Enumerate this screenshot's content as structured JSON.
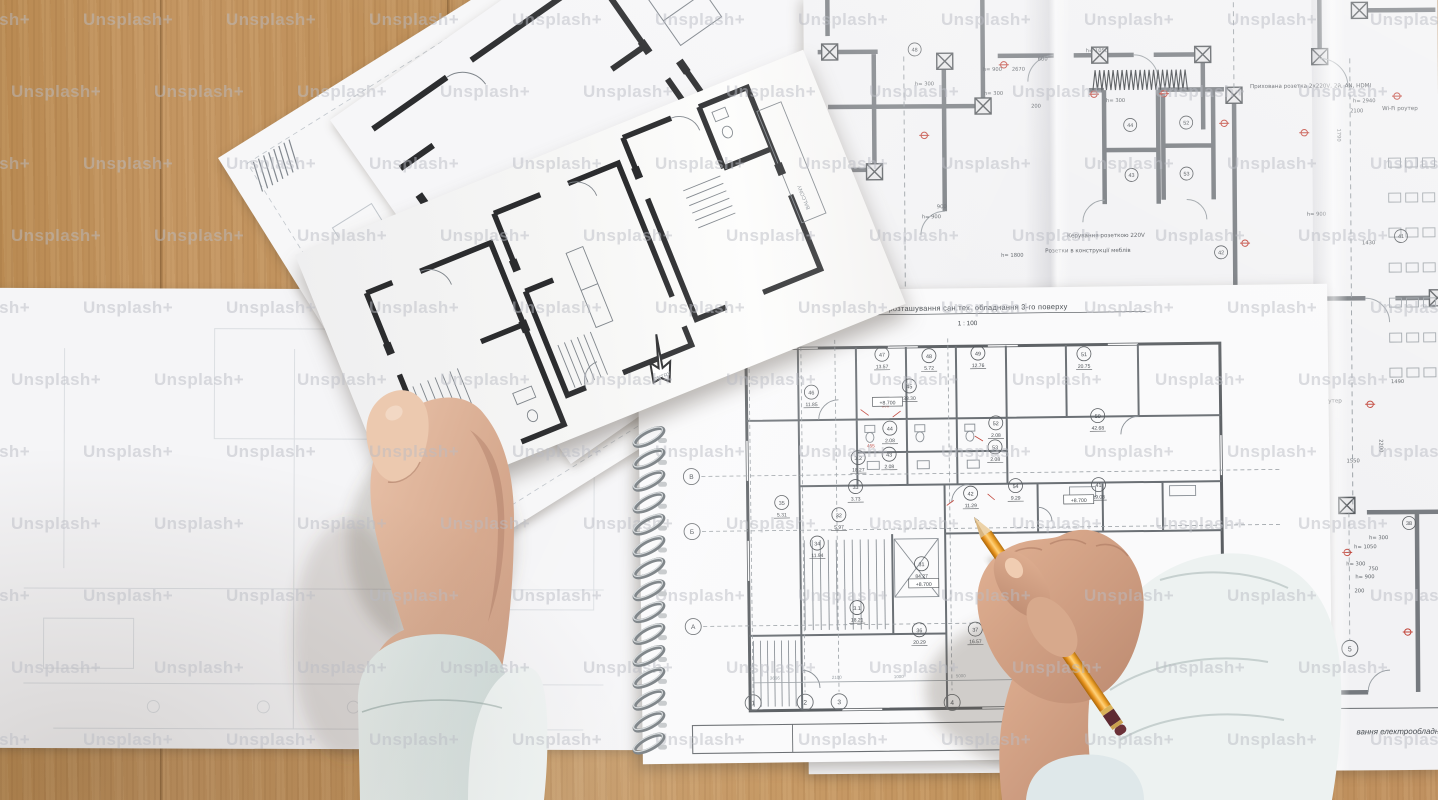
{
  "watermark": {
    "text": "Unsplash+"
  },
  "notebook": {
    "title": "План розташування сан.тех. обладнання 3-го поверху",
    "scale": "1 : 100",
    "page_number": "13",
    "titleblock_partial": "…поверху",
    "grid_rows": [
      "В",
      "Б",
      "А"
    ],
    "grid_cols": [
      "1",
      "2",
      "3",
      "4"
    ],
    "elevation_mark": "+8.700",
    "elevation_positions": [
      {
        "x": 249,
        "y": 114
      },
      {
        "x": 283,
        "y": 296
      },
      {
        "x": 439,
        "y": 214
      }
    ],
    "faint_dims": [
      "3666",
      "2100",
      "1000",
      "5000"
    ],
    "red_dims": [
      "500",
      "455"
    ],
    "rooms": [
      {
        "num": "46",
        "area": "11.85",
        "x": 173,
        "y": 107
      },
      {
        "num": "47",
        "area": "13.57",
        "x": 244,
        "y": 70
      },
      {
        "num": "48",
        "area": "5.72",
        "x": 291,
        "y": 72
      },
      {
        "num": "49",
        "area": "12.76",
        "x": 340,
        "y": 70
      },
      {
        "num": "51",
        "area": "20.75",
        "x": 446,
        "y": 72
      },
      {
        "num": "45",
        "area": "38.30",
        "x": 271,
        "y": 102
      },
      {
        "num": "44",
        "area": "2.08",
        "x": 251,
        "y": 144
      },
      {
        "num": "43",
        "area": "2.08",
        "x": 250,
        "y": 170
      },
      {
        "num": "52",
        "area": "2.08",
        "x": 357,
        "y": 140
      },
      {
        "num": "53",
        "area": "2.08",
        "x": 356,
        "y": 164
      },
      {
        "num": "50",
        "area": "42.68",
        "x": 459,
        "y": 134
      },
      {
        "num": "42",
        "area": "11.29",
        "x": 331,
        "y": 210
      },
      {
        "num": "54",
        "area": "9.29",
        "x": 376,
        "y": 203
      },
      {
        "num": "41",
        "area": "19.08",
        "x": 459,
        "y": 203
      },
      {
        "num": "3.2",
        "area": "18.27",
        "x": 219,
        "y": 173
      },
      {
        "num": "33",
        "area": "3.73",
        "x": 216,
        "y": 202
      },
      {
        "num": "35",
        "area": "5.31",
        "x": 142,
        "y": 217
      },
      {
        "num": "32",
        "area": "5.97",
        "x": 199,
        "y": 230
      },
      {
        "num": "34",
        "area": "11.94",
        "x": 177,
        "y": 258
      },
      {
        "num": "31",
        "area": "84.27",
        "x": 281,
        "y": 280
      },
      {
        "num": "3.1",
        "area": "18.21",
        "x": 216,
        "y": 323
      },
      {
        "num": "36",
        "area": "20.29",
        "x": 278,
        "y": 346
      },
      {
        "num": "37",
        "area": "16.57",
        "x": 334,
        "y": 346
      }
    ]
  },
  "electrical_plan": {
    "labels": {
      "wifi_router": "Wi-Fi роутер",
      "hidden_socket": "Прихована розетка 2х220V, 2й, AN, HDMI",
      "socket_control": "Керування розеткою 220V",
      "furniture_sockets": "Розетки в конструкції меблів",
      "bottom_title_partial": "вання електрообладнання 3-го п",
      "grid_bubble": "5"
    },
    "red_dim": "350",
    "red_dim_positions": [
      {
        "x": 400,
        "y": 510
      },
      {
        "x": 404,
        "y": 556
      },
      {
        "x": 406,
        "y": 600
      },
      {
        "x": 398,
        "y": 628
      }
    ],
    "rooms": [
      {
        "num": "48",
        "x": 111,
        "y": 54
      },
      {
        "num": "44",
        "x": 326,
        "y": 131
      },
      {
        "num": "43",
        "x": 327,
        "y": 181
      },
      {
        "num": "52",
        "x": 382,
        "y": 129
      },
      {
        "num": "53",
        "x": 382,
        "y": 180
      },
      {
        "num": "42",
        "x": 416,
        "y": 259
      },
      {
        "num": "41",
        "x": 596,
        "y": 244
      },
      {
        "num": "38",
        "x": 602,
        "y": 531
      }
    ],
    "dims": [
      {
        "t": "h= 900",
        "x": 179,
        "y": 76
      },
      {
        "t": "2670",
        "x": 208,
        "y": 76
      },
      {
        "t": "h= 300",
        "x": 302,
        "y": 108
      },
      {
        "t": "200",
        "x": 227,
        "y": 113
      },
      {
        "t": "600",
        "x": 234,
        "y": 66
      },
      {
        "t": "h= 1050",
        "x": 282,
        "y": 58
      },
      {
        "t": "h= 1800",
        "x": 196,
        "y": 262
      },
      {
        "t": "h= 900",
        "x": 117,
        "y": 223
      },
      {
        "t": "h= 2935",
        "x": 412,
        "y": 390
      },
      {
        "t": "2200",
        "x": 573,
        "y": 447,
        "r": 90
      },
      {
        "t": "1550",
        "x": 540,
        "y": 470
      },
      {
        "t": "1490",
        "x": 585,
        "y": 391
      },
      {
        "t": "h= 2940",
        "x": 549,
        "y": 110
      },
      {
        "t": "2100",
        "x": 546,
        "y": 120
      },
      {
        "t": "1790",
        "x": 533,
        "y": 136,
        "r": 90
      },
      {
        "t": "h= 300",
        "x": 539,
        "y": 573
      },
      {
        "t": "h= 900",
        "x": 548,
        "y": 586
      },
      {
        "t": "750",
        "x": 561,
        "y": 578
      },
      {
        "t": "200",
        "x": 547,
        "y": 600
      },
      {
        "t": "h= 300",
        "x": 562,
        "y": 547
      },
      {
        "t": "h= 1050",
        "x": 547,
        "y": 556
      },
      {
        "t": "900",
        "x": 132,
        "y": 213
      },
      {
        "t": "1650",
        "x": 427,
        "y": 626
      },
      {
        "t": "h= 300",
        "x": 180,
        "y": 100
      },
      {
        "t": "1430",
        "x": 557,
        "y": 252
      },
      {
        "t": "h= 900",
        "x": 502,
        "y": 223
      },
      {
        "t": "h= 300",
        "x": 111,
        "y": 90
      }
    ]
  },
  "held_plan": {
    "labels": {
      "balcony": "BALCONY",
      "entry": "ENTRY"
    }
  }
}
